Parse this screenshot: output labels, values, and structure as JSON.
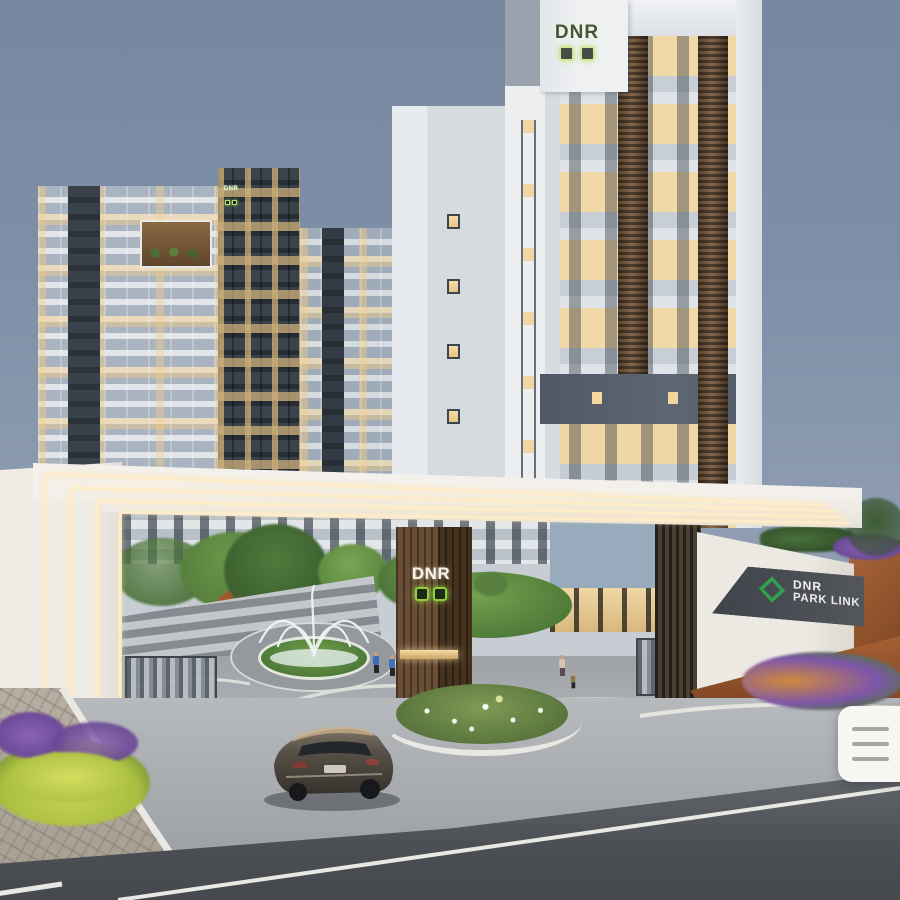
{
  "branding": {
    "name": "DNR",
    "project_name": "PARK LINK",
    "logo_green": "#2fa24c",
    "logo_square_green": "#8fce3f"
  },
  "signage": {
    "tower_top_text": "DNR",
    "back_tower_text": "DNR",
    "gate_pillar_text": "DNR",
    "entrance_wall_brand": "DNR",
    "entrance_wall_project": "PARK LINK"
  },
  "ui": {
    "menu_button": {
      "icon": "hamburger-menu-icon",
      "line_count": 3,
      "card_color": "#f7f6f3",
      "line_color": "#a7a7a5"
    }
  },
  "scene": {
    "description_colors": {
      "sky_top": "#76879f",
      "sky_horizon": "#97a5b7",
      "gate_white": "#f4f1ec",
      "led_warm": "#ffedc9",
      "wood_pillar": "#6a4f36",
      "sign_band": "#4a4e54",
      "rust_wall": "#a65f33",
      "grass": "#5c8a3f",
      "purple_flowers": "#7d55ab",
      "yellow_shrubs": "#c9d254",
      "concrete": "#b7babd",
      "asphalt": "#4b4f54",
      "car_body": "#4a443c"
    }
  }
}
